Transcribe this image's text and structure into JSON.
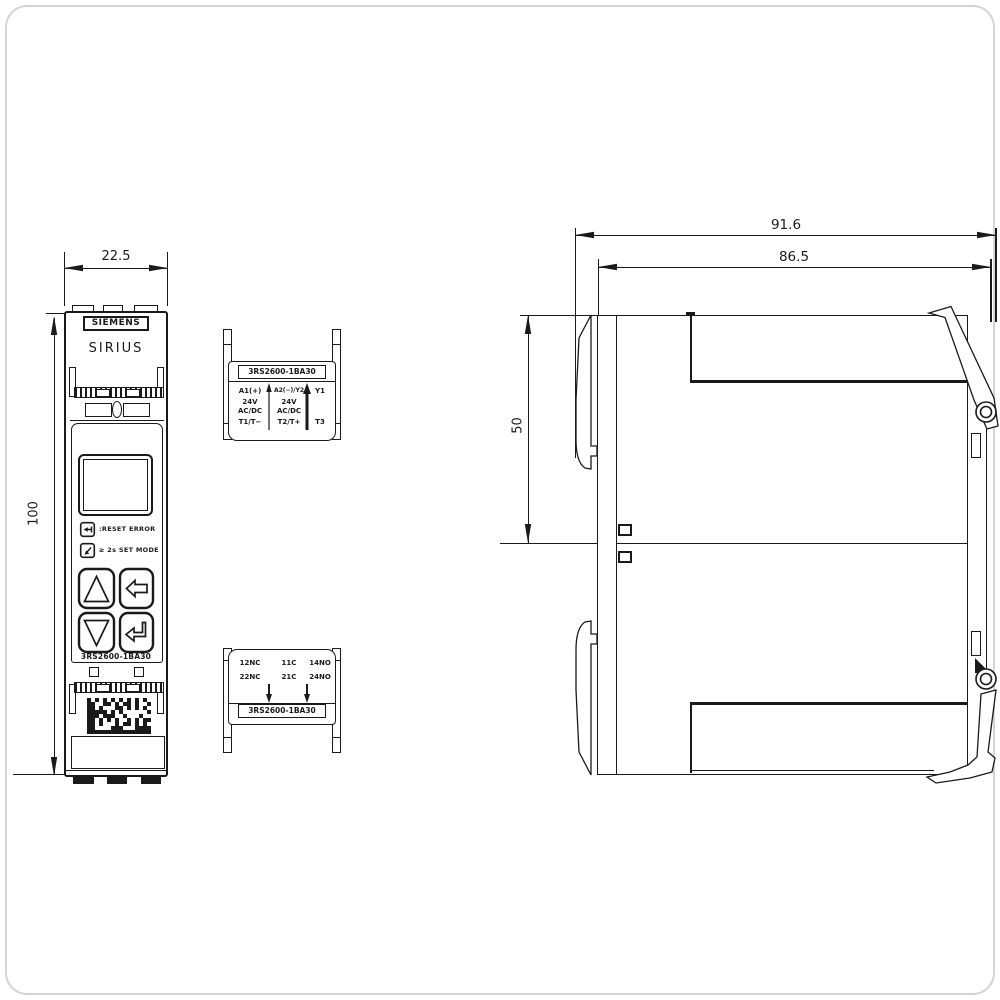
{
  "product": {
    "brand": "SIEMENS",
    "series": "SIRIUS",
    "part_number": "3RS2600-1BA30"
  },
  "dimensions": {
    "front_width_mm": "22.5",
    "front_height_mm": "100",
    "side_total_depth_mm": "91.6",
    "side_body_depth_mm": "86.5",
    "side_upper_height_mm": "50"
  },
  "front_panel": {
    "reset_label": ":RESET ERROR",
    "set_mode_label": "≥ 2s SET MODE",
    "part_number": "3RS2600-1BA30"
  },
  "terminal_top": {
    "part_number": "3RS2600-1BA30",
    "col1": [
      "A1(+)",
      "24V",
      "AC/DC",
      "T1/T−"
    ],
    "col2": [
      "A2(−)/Y2",
      "24V",
      "AC/DC",
      "T2/T+"
    ],
    "col3_top": "Y1",
    "col3_bottom": "T3"
  },
  "terminal_bottom": {
    "part_number": "3RS2600-1BA30",
    "row1": [
      "12NC",
      "11C",
      "14NO"
    ],
    "row2": [
      "22NC",
      "21C",
      "24NO"
    ]
  },
  "icons": {
    "up-arrow-button": "△",
    "down-arrow-button": "▽",
    "back-arrow-button": "⇦",
    "enter-button": "↵",
    "reset-icon": "⇤",
    "set-mode-icon": "↙",
    "din-clip-screw": "◎"
  },
  "colors": {
    "line": "#1a1a1a",
    "background": "#ffffff",
    "frame": "#d4d4d4"
  }
}
